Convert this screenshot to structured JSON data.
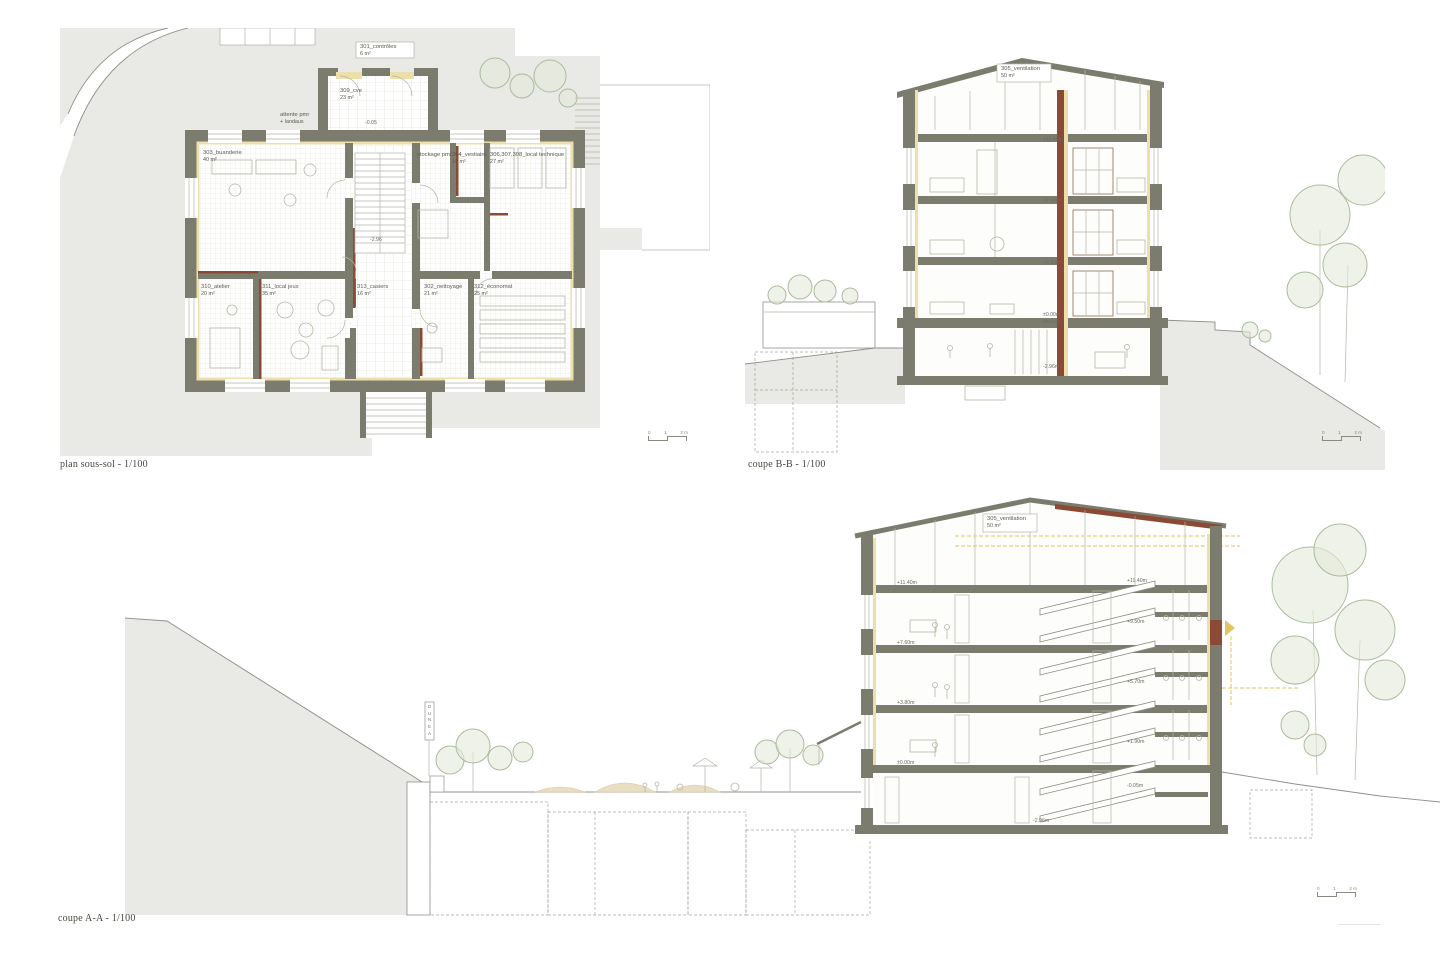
{
  "colors": {
    "site_gray": "#e9e9e5",
    "wall": "#7c7c6e",
    "lining": "#ecdfab",
    "red_accent": "#8a4a35",
    "furniture": "#b7b7aa",
    "tree_stroke": "#a9bc9e",
    "tree_fill": "#e4ead9",
    "terrain_line": "#90908a",
    "dashed_line": "#a5a59a",
    "gold": "#e2c462",
    "sand": "#e9ddc2",
    "ink": "#55554b"
  },
  "captions": {
    "plan": "plan sous-sol - 1/100",
    "coupe_bb": "coupe B-B - 1/100",
    "coupe_aa": "coupe A-A - 1/100"
  },
  "scalebar": {
    "zero": "0",
    "one": "1",
    "two": "2 m"
  },
  "plan": {
    "rooms": [
      {
        "line1": "301_contrôles",
        "line2": "6 m²"
      },
      {
        "line1": "309_cve",
        "line2": "23 m²"
      },
      {
        "line1": "attente pmr",
        "line2": "+ landaus"
      },
      {
        "line1": "303_buanderie",
        "line2": "40 m²"
      },
      {
        "line1": "stockage pmr",
        "line2": ""
      },
      {
        "line1": "304_vestiaire",
        "line2": "10 m²"
      },
      {
        "line1": "306,307,308_local technique",
        "line2": "27 m²"
      },
      {
        "line1": "310_atelier",
        "line2": "20 m²"
      },
      {
        "line1": "311_local jeux",
        "line2": "35 m²"
      },
      {
        "line1": "313_casiers",
        "line2": "16 m²"
      },
      {
        "line1": "302_nettoyage",
        "line2": "21 m²"
      },
      {
        "line1": "312_économat",
        "line2": "25 m²"
      }
    ],
    "levels": [
      "-0.05",
      "-2.96"
    ]
  },
  "coupe_bb": {
    "attic": {
      "line1": "305_ventilation",
      "line2": "50 m²"
    },
    "levels": [
      "+11.40m",
      "+7.60m",
      "+3.80m",
      "±0.00m",
      "998.50m",
      "-2.96m"
    ]
  },
  "coupe_aa": {
    "attic": {
      "line1": "305_ventilation",
      "line2": "50 m²"
    },
    "levels_right": [
      "+11.40m",
      "+9.50m",
      "+5.70m",
      "+1.90m",
      "-0.05m",
      "-2.96m"
    ],
    "levels_left": [
      "+11.40m",
      "+7.60m",
      "+3.80m",
      "±0.00m"
    ],
    "sign": "D\nU\nN\nE\nA"
  }
}
